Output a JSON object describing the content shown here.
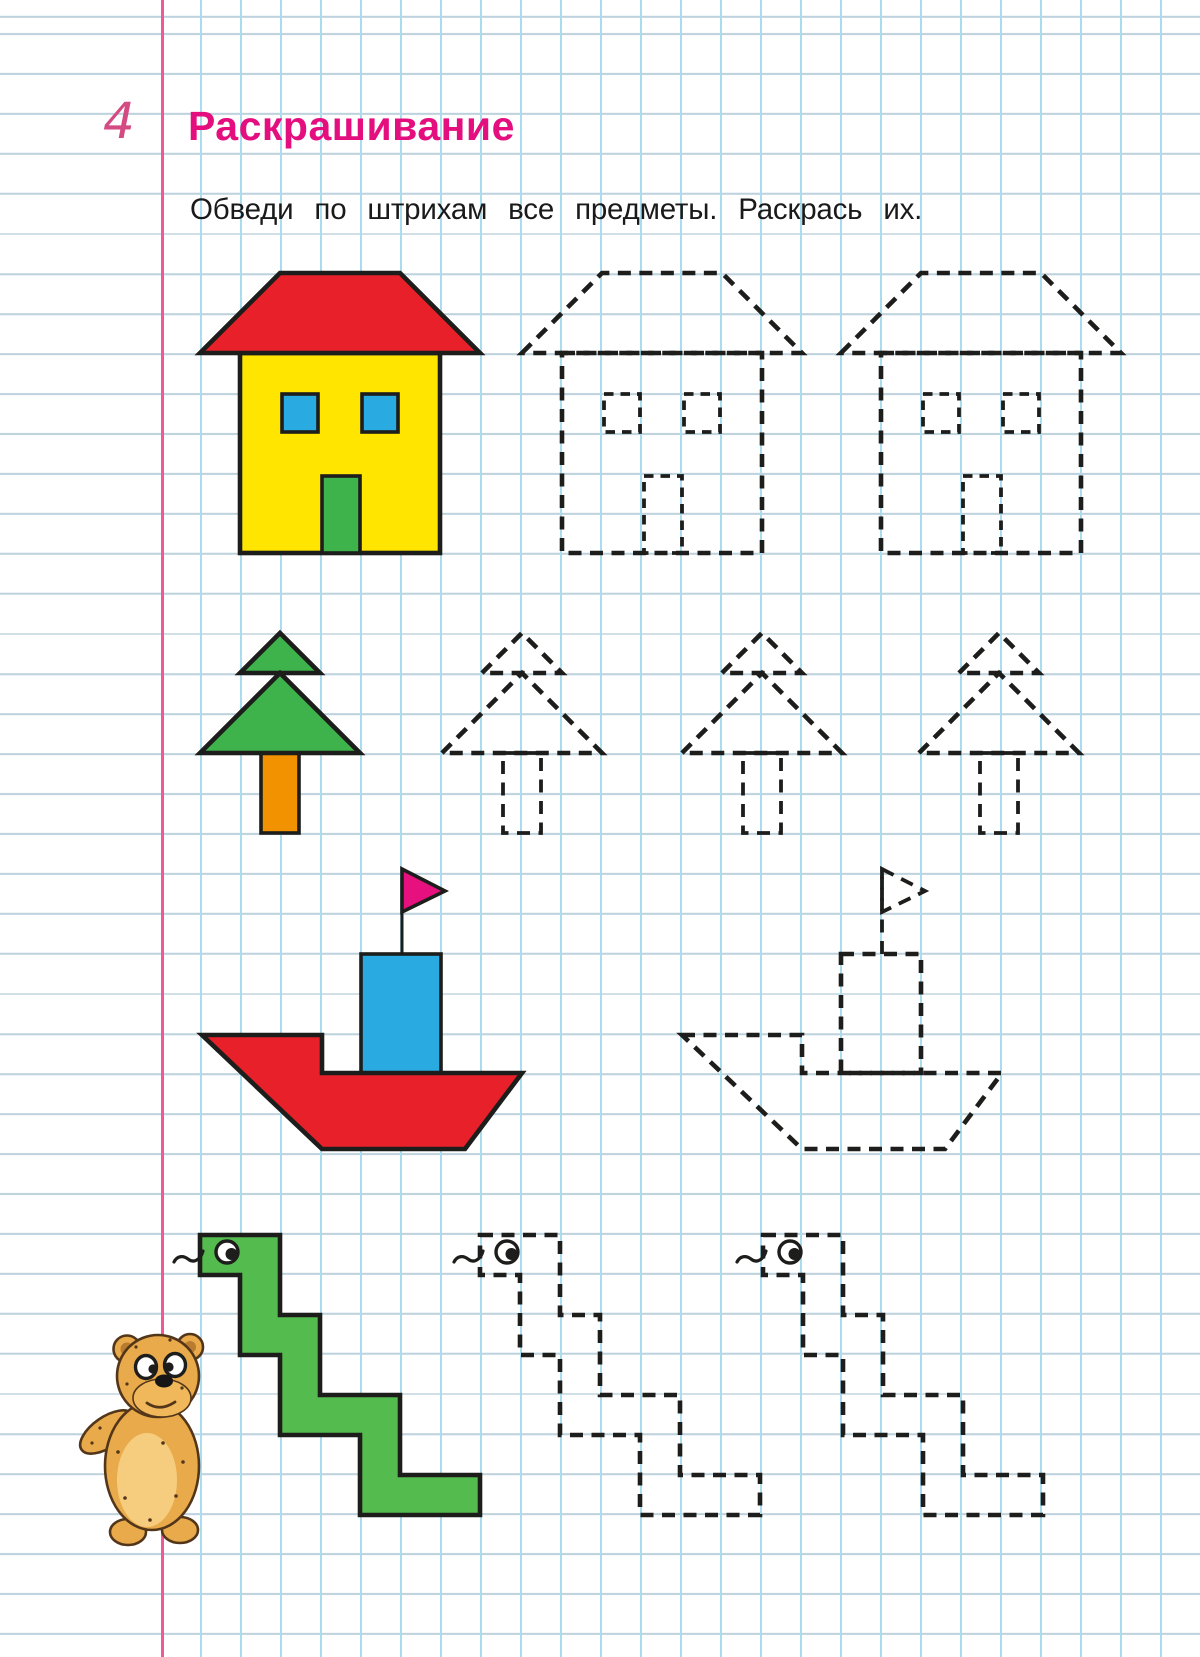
{
  "page": {
    "number": "4",
    "title": "Раскрашивание",
    "instruction": "Обведи по штрихам все предметы. Раскрась их."
  },
  "worksheet": {
    "rows": [
      {
        "object": "house",
        "colored_examples": 1,
        "dashed_outlines": 2
      },
      {
        "object": "fir-tree",
        "colored_examples": 1,
        "dashed_outlines": 3
      },
      {
        "object": "boat",
        "colored_examples": 1,
        "dashed_outlines": 1
      },
      {
        "object": "snake",
        "colored_examples": 1,
        "dashed_outlines": 2
      }
    ],
    "mascot": "teddy-bear"
  },
  "colors": {
    "title": "#e40e7e",
    "page_number": "#d44a82",
    "margin_line": "#f4569b",
    "grid_vertical": "#a9dcee",
    "grid_horizontal": "#bdd2dd",
    "text": "#1a1a1a",
    "outline": "#1d1d1b",
    "red": "#e8202a",
    "yellow": "#ffe500",
    "blue": "#29abe2",
    "green": "#3eb24b",
    "orange": "#f39200",
    "magenta": "#e6117e",
    "snake_green": "#54bb4e",
    "bear_fur": "#e8aa4a",
    "bear_belly": "#f6cd7e",
    "bear_muzzle": "#f0b75b",
    "bear_inner_ear": "#b97c2e",
    "bear_outline": "#53361a"
  }
}
